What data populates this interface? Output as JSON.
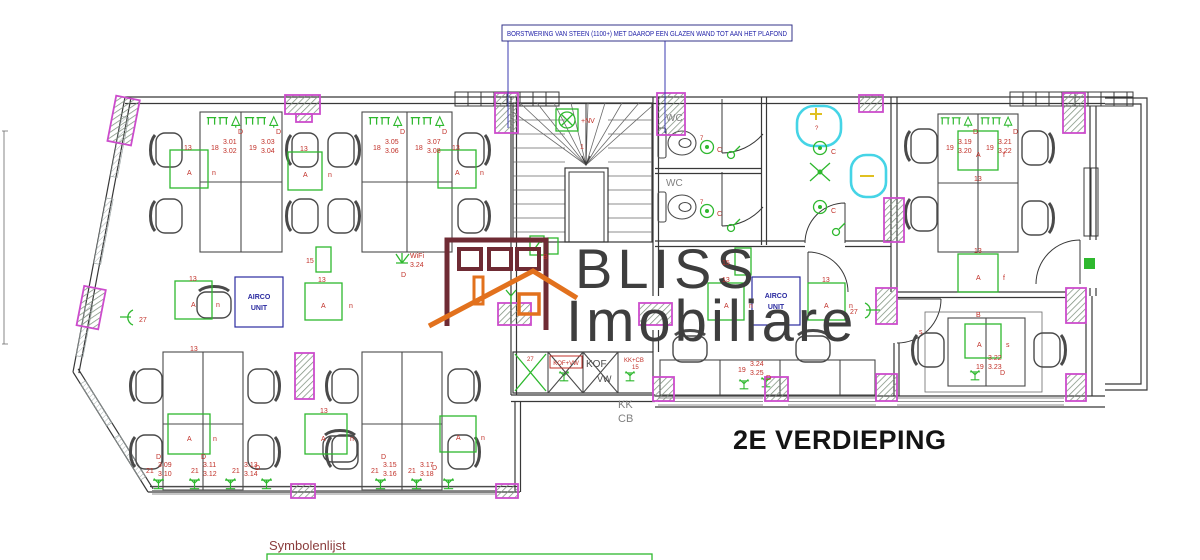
{
  "labels": {
    "annotation": "BORSTWERING VAN STEEN (1100+) MET DAAROP EEN GLAZEN WAND TOT AAN HET PLAFOND",
    "title": "2E VERDIEPING",
    "symbolenlijst": "Symbolenlijst",
    "logo1": "BLISS",
    "logo2": "Imobiliare",
    "wc": "WC",
    "airco1": "AIRCO",
    "airco2": "UNIT",
    "kof": "KOF",
    "vw": "VW",
    "kofvw": "KOF+VW",
    "kkcb": "KK+CB",
    "n15k": "15",
    "kk": "KK",
    "cb": "CB",
    "nv": "+NV",
    "one": "1",
    "wifi1": "WiFi",
    "wifi2": "3.24",
    "a": "A",
    "n": "n",
    "f": "f",
    "s": "s",
    "b": "B",
    "c": "C",
    "d": "D",
    "t13": "13",
    "t15": "15",
    "n27": "27",
    "q7": "7",
    "qm": "?"
  },
  "codes": [
    {
      "n": "18",
      "a": "3.01",
      "b": "3.02"
    },
    {
      "n": "19",
      "a": "3.03",
      "b": "3.04"
    },
    {
      "n": "18",
      "a": "3.05",
      "b": "3.06"
    },
    {
      "n": "18",
      "a": "3.07",
      "b": "3.08"
    },
    {
      "n": "21",
      "a": "3.09",
      "b": "3.10"
    },
    {
      "n": "21",
      "a": "3.11",
      "b": "3.12"
    },
    {
      "n": "21",
      "a": "3.13",
      "b": "3.14"
    },
    {
      "n": "21",
      "a": "3.15",
      "b": "3.16"
    },
    {
      "n": "21",
      "a": "3.17",
      "b": "3.18"
    },
    {
      "n": "19",
      "a": "3.19",
      "b": "3.20"
    },
    {
      "n": "19",
      "a": "3.21",
      "b": "3.22"
    },
    {
      "n": "19",
      "a": "3.22",
      "b": "3.23"
    },
    {
      "n": "19",
      "a": "3.24",
      "b": "3.25"
    }
  ],
  "colors": {
    "column_magenta": "#cc4ccc",
    "symbol_green": "#2eb82e",
    "label_red": "#c13028",
    "annotation_blue": "#2b2ba0",
    "basin_cyan": "#45d4e6",
    "logo_gray": "#3e3e3e",
    "logo_orange": "#e2711d",
    "logo_maroon": "#6f2b34"
  }
}
